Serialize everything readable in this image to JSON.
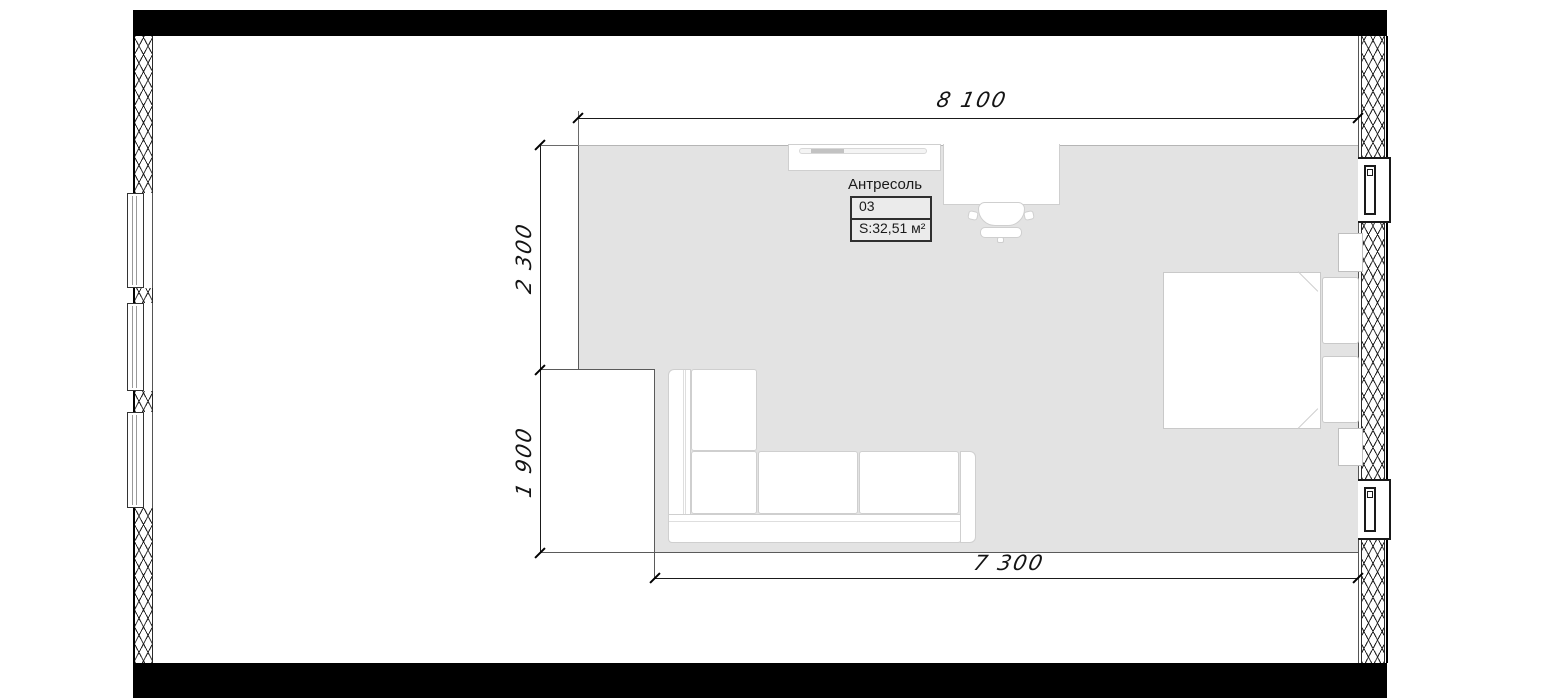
{
  "room_tag": {
    "name": "Антресоль",
    "number": "03",
    "area": "S:32,51 м²"
  },
  "dimensions": {
    "top": "8 100",
    "side_upper": "2 300",
    "side_lower": "1 900",
    "bottom": "7 300"
  },
  "colors": {
    "floor": "#e3e3e3",
    "bearing_wall": "#000000",
    "dimension_line": "#1a1a1a",
    "furniture_border": "#cfcfcf"
  },
  "furniture_names": [
    "wardrobe",
    "desk",
    "office-chair",
    "corner-sofa",
    "bed",
    "pillow",
    "nightstand"
  ]
}
